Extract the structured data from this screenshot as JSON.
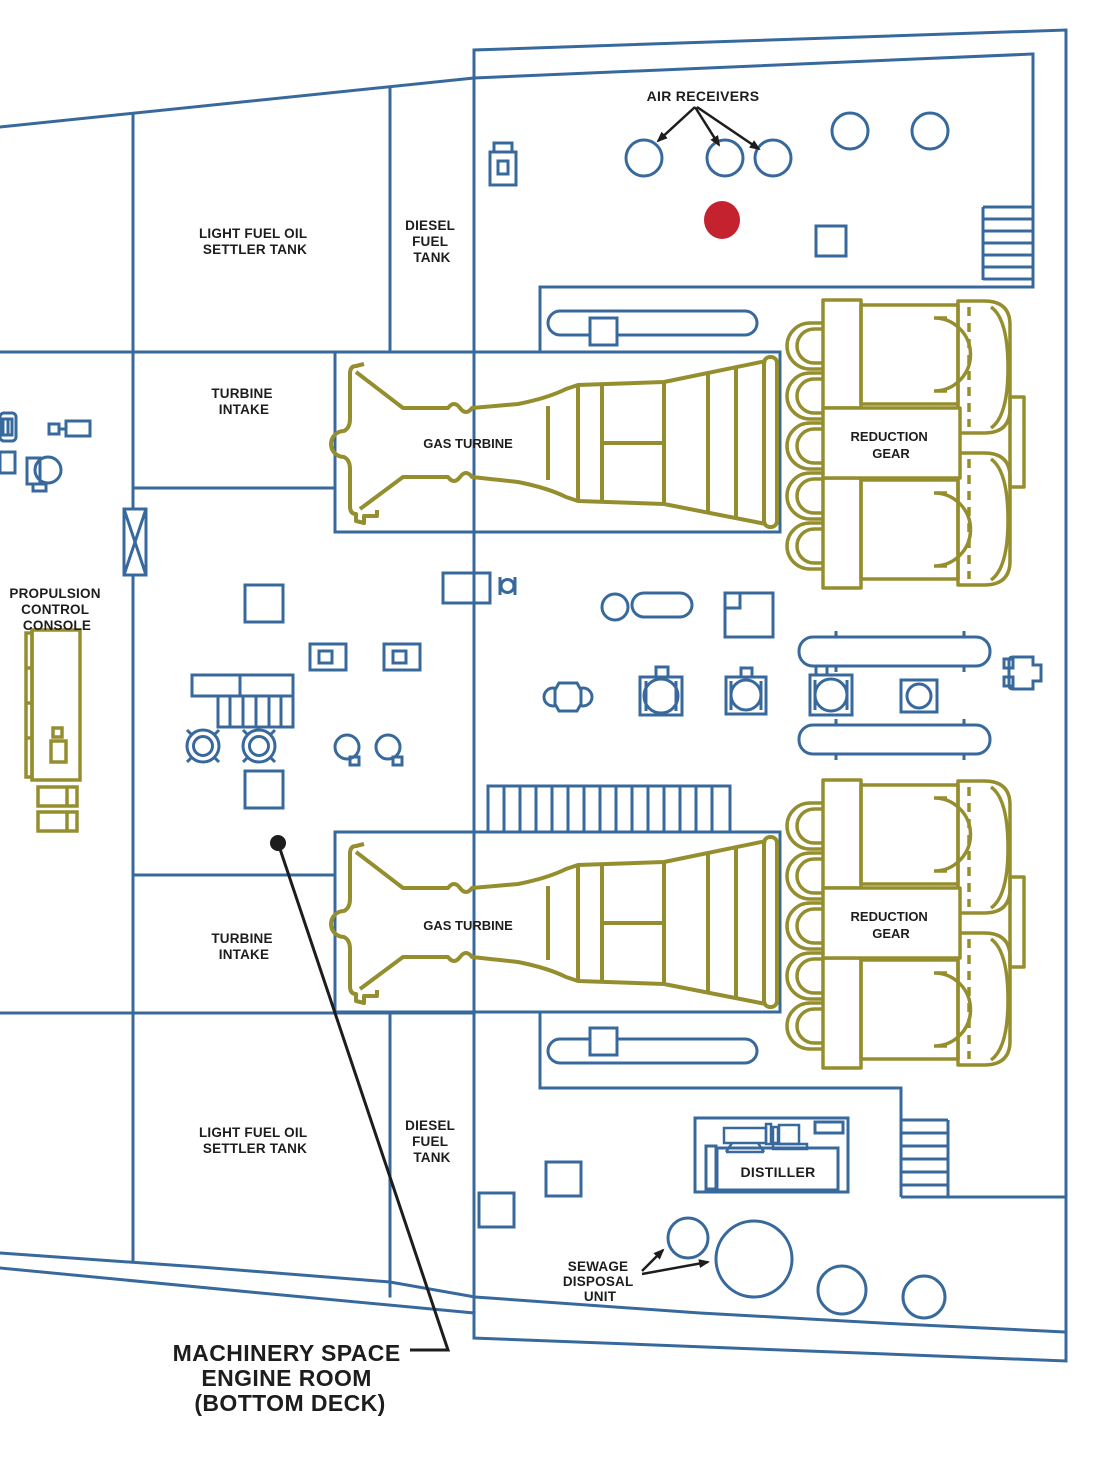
{
  "colors": {
    "structure_blue": "#38699D",
    "machinery_olive": "#958E2F",
    "marker_red": "#C5222F",
    "annotation_black": "#1D1D1D"
  },
  "labels": {
    "air_receivers": "AIR RECEIVERS",
    "settler_tank_top": [
      "LIGHT FUEL OIL",
      "SETTLER TANK"
    ],
    "diesel_tank_top": [
      "DIESEL",
      "FUEL",
      "TANK"
    ],
    "turbine_intake_forward": [
      "TURBINE",
      "INTAKE"
    ],
    "propulsion_console": [
      "PROPULSION",
      "CONTROL",
      "CONSOLE"
    ],
    "gas_turbine_forward": "GAS TURBINE",
    "gas_turbine_aft": "GAS TURBINE",
    "reduction_gear_forward": [
      "REDUCTION",
      "GEAR"
    ],
    "reduction_gear_aft": [
      "REDUCTION",
      "GEAR"
    ],
    "turbine_intake_aft": [
      "TURBINE",
      "INTAKE"
    ],
    "settler_tank_bottom": [
      "LIGHT FUEL OIL",
      "SETTLER TANK"
    ],
    "diesel_tank_bottom": [
      "DIESEL",
      "FUEL",
      "TANK"
    ],
    "distiller": "DISTILLER",
    "sewage_disposal": [
      "SEWAGE",
      "DISPOSAL",
      "UNIT"
    ],
    "caption": [
      "MACHINERY SPACE",
      "ENGINE ROOM",
      "(BOTTOM DECK)"
    ]
  }
}
